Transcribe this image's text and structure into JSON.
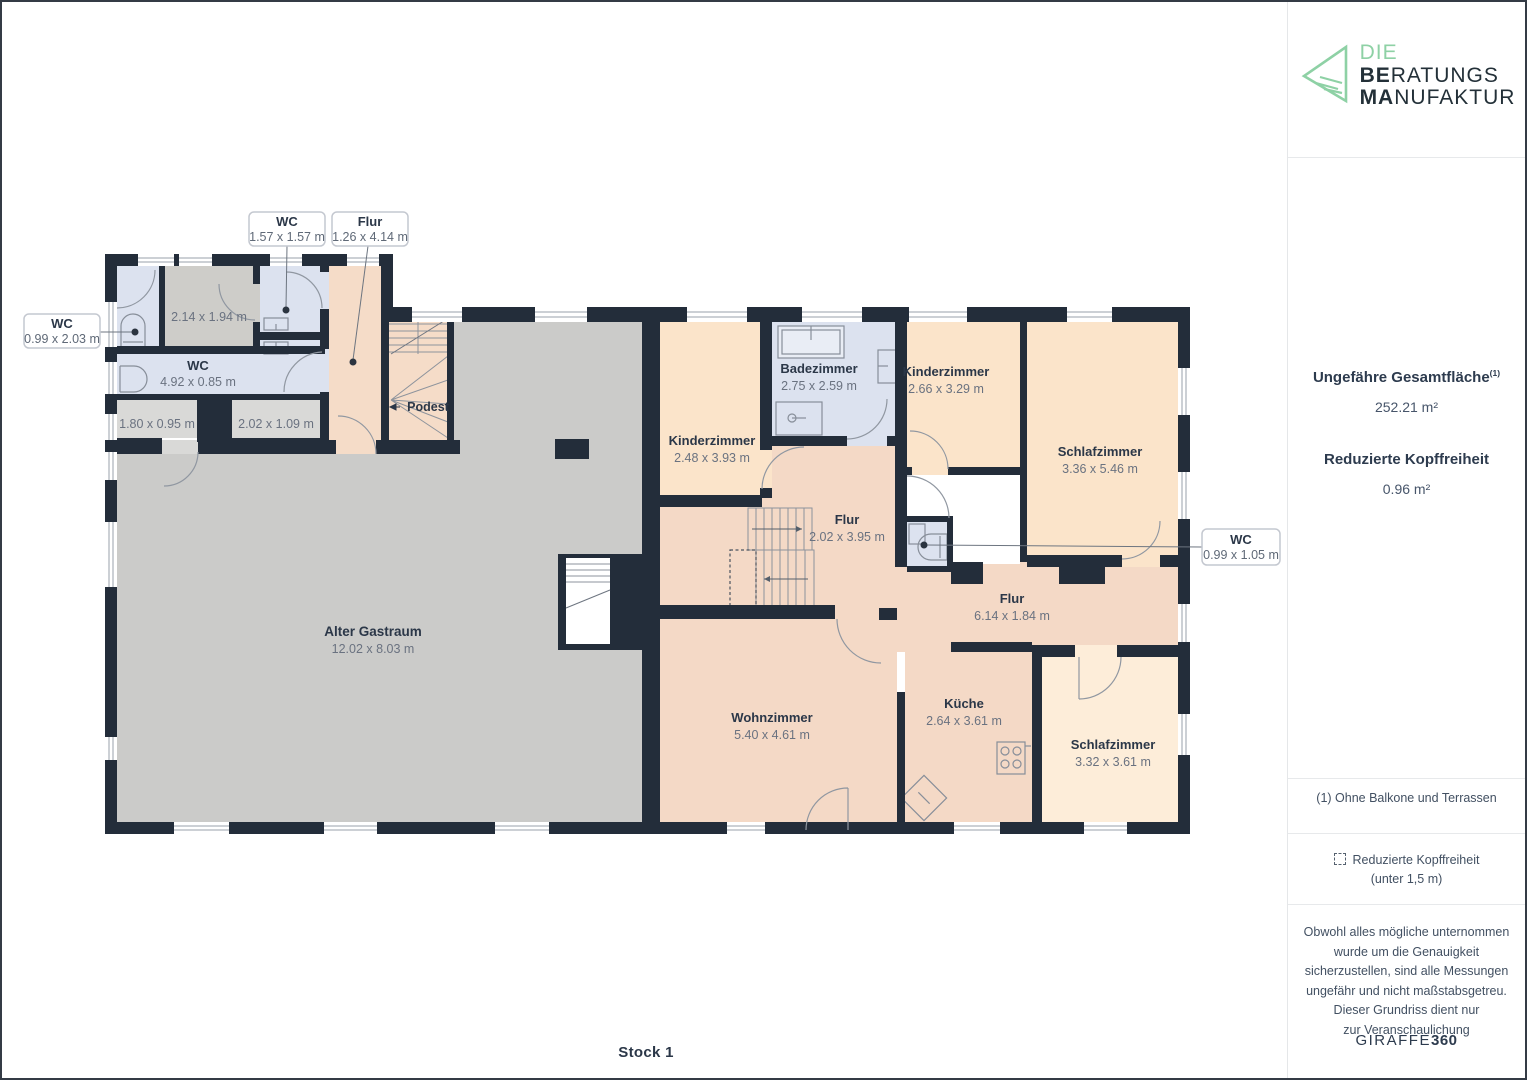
{
  "frame": {
    "floor_label": "Stock 1"
  },
  "sidebar": {
    "logo": {
      "word1": "DIE",
      "word2_bold": "BE",
      "word2_rest": "RATUNGS",
      "word3_bold": "MA",
      "word3_rest": "NUFAKTUR"
    },
    "total_area_label": "Ungefähre Gesamtfläche",
    "total_area_sup": "(1)",
    "total_area_value": "252.21 m²",
    "reduced_label": "Reduzierte Kopffreiheit",
    "reduced_value": "0.96 m²",
    "footnote": "(1) Ohne Balkone und Terrassen",
    "legend_label": "Reduzierte Kopffreiheit",
    "legend_sub": "(unter 1,5 m)",
    "disclaimer_lines": [
      "Obwohl alles mögliche unternommen",
      "wurde um die Genauigkeit",
      "sicherzustellen, sind alle Messungen",
      "ungefähr und nicht maßstabsgetreu.",
      "Dieser Grundriss dient nur",
      "zur Veranschaulichung"
    ],
    "brand_name": "GIRAFFE",
    "brand_suffix": "360"
  },
  "callouts": {
    "wc_top": {
      "title": "WC",
      "dims": "1.57 x 1.57 m"
    },
    "flur_top": {
      "title": "Flur",
      "dims": "1.26 x 4.14 m"
    },
    "wc_left": {
      "title": "WC",
      "dims": "0.99 x 2.03 m"
    },
    "wc_right": {
      "title": "WC",
      "dims": "0.99 x 1.05 m"
    }
  },
  "rooms": {
    "storage_small": {
      "dims": "2.14 x 1.94 m"
    },
    "wc_corridor": {
      "name": "WC",
      "dims": "4.92 x 0.85 m"
    },
    "niche_left": {
      "dims": "1.80 x 0.95 m"
    },
    "niche_right": {
      "dims": "2.02 x 1.09 m"
    },
    "podest": {
      "name": "Podest"
    },
    "gastraum": {
      "name": "Alter Gastraum",
      "dims": "12.02 x 8.03 m"
    },
    "kinderzimmer_1": {
      "name": "Kinderzimmer",
      "dims": "2.48 x 3.93 m"
    },
    "badezimmer": {
      "name": "Badezimmer",
      "dims": "2.75 x 2.59 m"
    },
    "kinderzimmer_2": {
      "name": "Kinderzimmer",
      "dims": "2.66 x 3.29 m"
    },
    "schlafzimmer_1": {
      "name": "Schlafzimmer",
      "dims": "3.36 x 5.46 m"
    },
    "flur_mitte": {
      "name": "Flur",
      "dims": "2.02 x 3.95 m"
    },
    "flur_unten": {
      "name": "Flur",
      "dims": "6.14 x 1.84 m"
    },
    "wohnzimmer": {
      "name": "Wohnzimmer",
      "dims": "5.40 x 4.61 m"
    },
    "kueche": {
      "name": "Küche",
      "dims": "2.64 x 3.61 m"
    },
    "schlafzimmer_2": {
      "name": "Schlafzimmer",
      "dims": "3.32 x 3.61 m"
    }
  },
  "colors": {
    "wall": "#232d3a",
    "room_gray": "#cbcbc9",
    "room_gray_warm": "#cecdc9",
    "niche_gray": "#d9d9d7",
    "room_blue": "#dce2ef",
    "room_peach": "#fbe4ca",
    "room_pink": "#f4d9c6",
    "room_peach_light": "#fdedd9",
    "accent_green": "#8ed1a5",
    "text_dark": "#2b3748",
    "text_dim": "#6a7280"
  }
}
